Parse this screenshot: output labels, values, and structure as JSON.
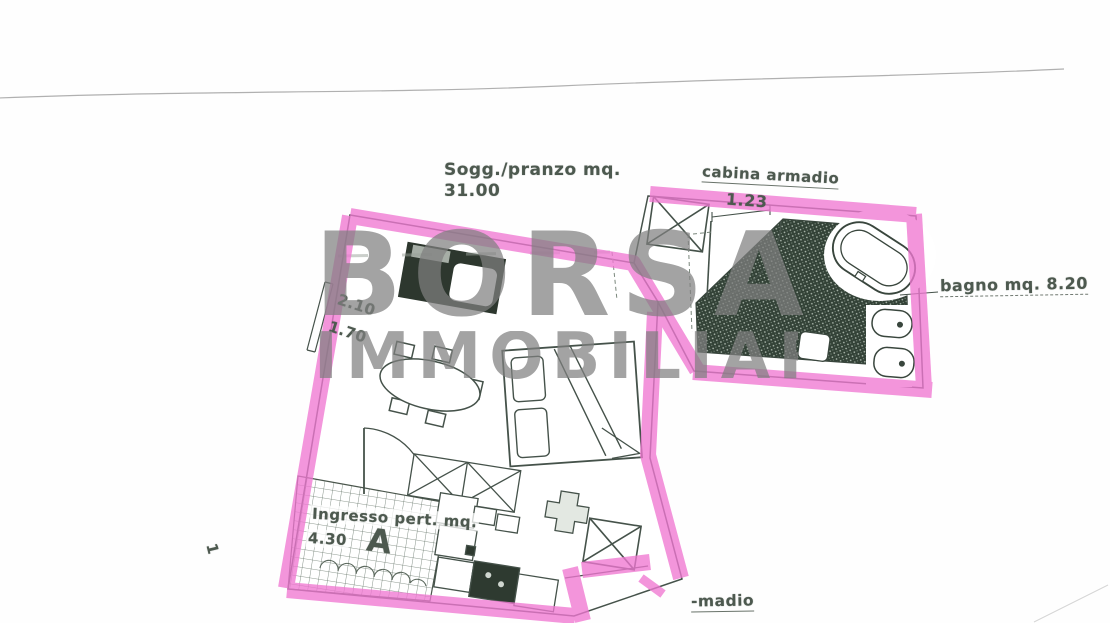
{
  "document": {
    "type_note": "scanned apartment floor plan with pink highlighter on walls",
    "watermark": {
      "line1": "BORSA",
      "line2": "IMMOBILIARE"
    },
    "labels": {
      "living_room": {
        "line1": "Sogg./pranzo mq.",
        "area_value": "31.00"
      },
      "closet": {
        "name": "cabina armadio",
        "width_dimension": "1.23"
      },
      "bathroom": {
        "name": "bagno mq. 8.20"
      },
      "entrance": {
        "line1": "Ingresso pert. mq.",
        "area_value": "4.30",
        "section_letter": "A"
      },
      "window_dimensions": {
        "width": "2.10",
        "height": "1.70"
      },
      "page_mark": "1",
      "truncated_label": "-madio"
    },
    "colors": {
      "highlight_pink": "#f078d2",
      "ink": "#45524a",
      "hatch_dark": "#334237",
      "watermark_gray": "#808080"
    }
  }
}
